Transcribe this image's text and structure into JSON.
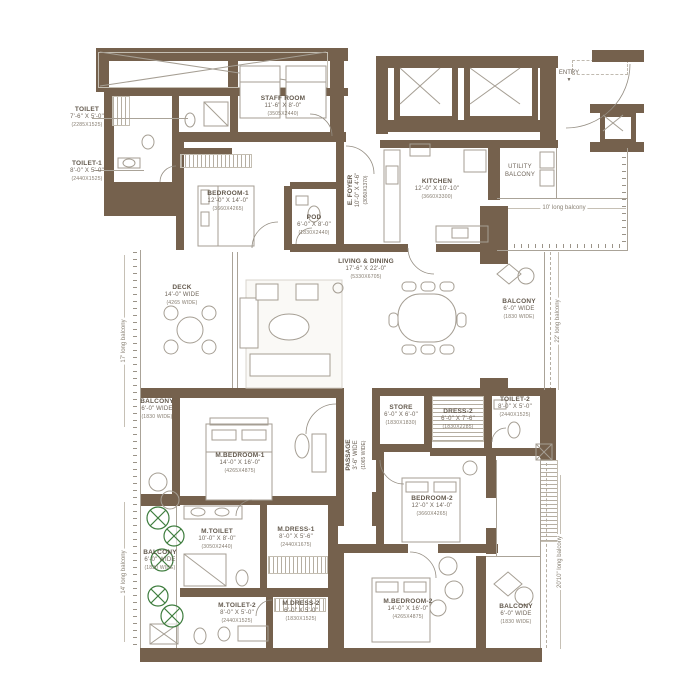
{
  "colors": {
    "wall": "#75614d",
    "line": "#aaa398",
    "text": "#6f655a",
    "tree_green": "#3e7d3e",
    "background": "#ffffff"
  },
  "entry": {
    "label": "ENTRY",
    "arrow": "▼"
  },
  "edge_labels": {
    "left_top": "17' long balcony",
    "left_bottom": "14' long balcony",
    "right_top": "10' long balcony",
    "right_mid": "22' long balcony",
    "right_bottom": "20'10\" long balcony"
  },
  "rooms": {
    "staff_room": {
      "name": "STAFF ROOM",
      "dims": "11'-6\" X 8'-0\"",
      "mm": "(3505X2440)"
    },
    "toilet": {
      "name": "TOILET",
      "dims": "7'-6\" X 5'-0\"",
      "mm": "(2285X1525)"
    },
    "toilet_1": {
      "name": "TOILET-1",
      "dims": "8'-0\" X 5'-0\"",
      "mm": "(2440X1525)"
    },
    "bedroom_1": {
      "name": "BEDROOM-1",
      "dims": "12'-0\" X 14'-0\"",
      "mm": "(3660X4265)"
    },
    "pod": {
      "name": "POD",
      "dims": "6'-0\" X 8'-0\"",
      "mm": "(1830X2440)"
    },
    "kitchen": {
      "name": "KITCHEN",
      "dims": "12'-0\" X 10'-10\"",
      "mm": "(3660X3300)"
    },
    "utility_balcony": {
      "name": "UTILITY BALCONY"
    },
    "e_foyer": {
      "name": "E. FOYER",
      "dims": "10'-0\" X 4'-6\"",
      "mm": "(3050X1370)"
    },
    "living_dining": {
      "name": "LIVING & DINING",
      "dims": "17'-6\" X 22'-0\"",
      "mm": "(5330X6705)"
    },
    "deck": {
      "name": "DECK",
      "dims": "14'-0\" WIDE",
      "mm": "(4265 WIDE)"
    },
    "m_bedroom_1": {
      "name": "M.BEDROOM-1",
      "dims": "14'-0\" X 16'-0\"",
      "mm": "(4265X4875)"
    },
    "passage": {
      "name": "PASSAGE",
      "dims": "3'-6\" WIDE",
      "mm": "(1065 WIDE)"
    },
    "store": {
      "name": "STORE",
      "dims": "6'-0\" X 6'-0\"",
      "mm": "(1830X1830)"
    },
    "dress_2": {
      "name": "DRESS-2",
      "dims": "6'-0\" X 7'-6\"",
      "mm": "(1830X2285)"
    },
    "toilet_2": {
      "name": "TOILET-2",
      "dims": "8'-0\" X 5'-0\"",
      "mm": "(2440X1525)"
    },
    "bedroom_2": {
      "name": "BEDROOM-2",
      "dims": "12'-0\" X 14'-0\"",
      "mm": "(3660X4265)"
    },
    "m_toilet": {
      "name": "M.TOILET",
      "dims": "10'-0\" X 8'-0\"",
      "mm": "(3050X2440)"
    },
    "m_dress_1": {
      "name": "M.DRESS-1",
      "dims": "8'-0\" X 5'-6\"",
      "mm": "(2440X1675)"
    },
    "m_toilet_2": {
      "name": "M.TOILET-2",
      "dims": "8'-0\" X 5'-0\"",
      "mm": "(2440X1525)"
    },
    "m_dress_2": {
      "name": "M.DRESS-2",
      "dims": "6'-0\" X 5'-0\"",
      "mm": "(1830X1525)"
    },
    "m_bedroom_2": {
      "name": "M.BEDROOM-2",
      "dims": "14'-0\" X 16'-0\"",
      "mm": "(4265X4875)"
    },
    "balcony": {
      "name": "BALCONY",
      "dims": "6'-0\" WIDE",
      "mm": "(1830 WIDE)"
    }
  }
}
